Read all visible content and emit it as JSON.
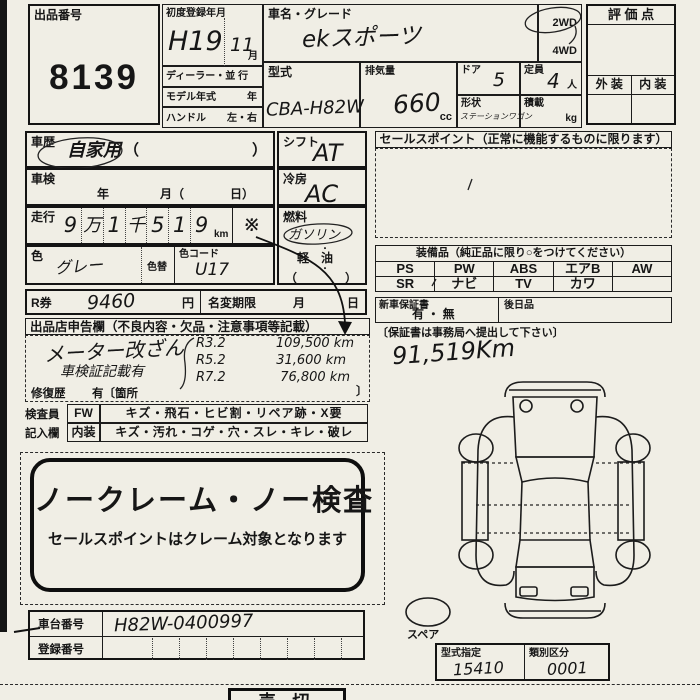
{
  "colors": {
    "paper": "#f0eee5",
    "ink": "#1b1b1b"
  },
  "header": {
    "lot_label": "出品番号",
    "lot_number": "8139",
    "first_reg_label": "初度登録年月",
    "first_reg_era_year": "H19",
    "first_reg_month": "11",
    "month_unit": "月",
    "dealer_row": "ディーラー・並 行",
    "model_year_label": "モデル年式",
    "year_unit": "年",
    "handle_label": "ハンドル",
    "handle_value": "左・右",
    "car_name_label": "車名・グレード",
    "car_name": "ekスポーツ",
    "model_code_label": "型式",
    "model_code": "CBA-H82W",
    "displacement_label": "排気量",
    "displacement": "660",
    "cc": "cc",
    "doors_label": "ドア",
    "doors": "5",
    "capacity_label": "定員",
    "capacity": "4",
    "capacity_unit": "人",
    "shape_label": "形状",
    "shape": "ステーションワゴン",
    "load_label": "積載",
    "load_unit": "kg",
    "drive_top": "2WD",
    "drive_bottom": "4WD",
    "score_label": "評 価 点",
    "exterior_label": "外 装",
    "interior_label": "内 装"
  },
  "left": {
    "history_label": "車歴",
    "history_value": "自家用",
    "paren_open": "（",
    "paren_close": "）",
    "shaken_label": "車検",
    "shaken_year": "年",
    "shaken_month": "月（",
    "shaken_day": "日）",
    "mileage_label": "走行",
    "mileage_cells": [
      "9",
      "万",
      "1",
      "千",
      "5",
      "1",
      "9"
    ],
    "km": "km",
    "asterisk": "※",
    "color_label": "色",
    "color_value": "グレー",
    "color_change": "色替",
    "color_code_label": "色コード",
    "color_code": "U17",
    "r_label": "R券",
    "r_value": "9460",
    "yen": "円",
    "name_change_label": "名変期限",
    "month": "月",
    "day": "日"
  },
  "mid": {
    "shift_label": "シフト",
    "shift": "AT",
    "ac_label": "冷房",
    "ac": "AC",
    "fuel_label": "燃料",
    "gasoline": "ガソリン",
    "dot": "・",
    "diesel": "軽　油",
    "paren": "（　　　　）"
  },
  "sales": {
    "header": "セールスポイント（正常に機能するものに限ります）"
  },
  "equipment": {
    "header": "装備品（純正品に限り○をつけてください）",
    "row1": [
      "PS",
      "PW",
      "ABS",
      "エアB",
      "AW"
    ],
    "row2": [
      "SR",
      "ナビ",
      "TV",
      "カワ",
      ""
    ]
  },
  "warranty": {
    "label": "新車保証書",
    "options": "有 ・ 無",
    "later_label": "後日品",
    "note": "〔保証書は事務局へ提出して下さい〕"
  },
  "odo_note": "91,519Km",
  "declaration": {
    "header": "出品店申告欄（不良内容・欠品・注意事項等記載）",
    "meter_note": "メーター改ざん",
    "shaken_note": "車検証記載有",
    "records": [
      {
        "date": "R3.2",
        "km": "109,500 km"
      },
      {
        "date": "R5.2",
        "km": "31,600 km"
      },
      {
        "date": "R7.2",
        "km": "76,800 km"
      }
    ],
    "repair_label": "修復歴",
    "repair_text": "有〔箇所",
    "repair_close": "〕",
    "inspector_label": "検査員",
    "fw": "FW",
    "fw_items": "キズ・飛石・ヒビ割・リペア跡・X要",
    "entry_label": "記入欄",
    "interior": "内装",
    "interior_items": "キズ・汚れ・コゲ・穴・スレ・キレ・破レ"
  },
  "banner": {
    "title": "ノークレーム・ノー検査",
    "subtitle": "セールスポイントはクレーム対象となります"
  },
  "bottom": {
    "chassis_label": "車台番号",
    "chassis": "H82W-0400997",
    "registration_label": "登録番号",
    "spare_label": "スペア",
    "type_label": "型式指定",
    "type_value": "15410",
    "class_label": "類別区分",
    "class_value": "0001",
    "sold": "売 切"
  }
}
